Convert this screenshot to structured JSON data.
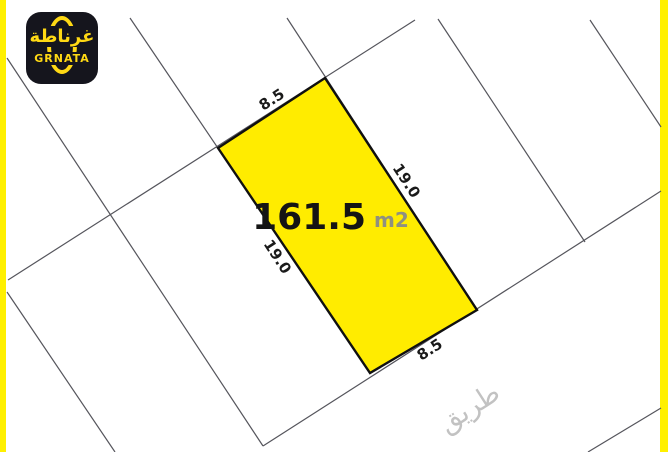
{
  "brand": {
    "logo_arabic": "غرناطة",
    "logo_latin": "GRNATA"
  },
  "parcel": {
    "area": "161.5",
    "unit": "m2",
    "dimensions": {
      "top": "8.5",
      "right": "19.0",
      "bottom": "8.5",
      "left": "19.0"
    }
  },
  "map": {
    "road_label": "طريق"
  },
  "colors": {
    "highlight_yellow": "#ffec00",
    "frame_yellow": "#fff000",
    "boundary_gray": "#55555c",
    "parcel_border": "#101010",
    "logo_bg": "#15151d",
    "logo_yellow": "#ffd914",
    "unit_gray": "#8f9080",
    "road_text_gray": "#c2c2c2"
  }
}
